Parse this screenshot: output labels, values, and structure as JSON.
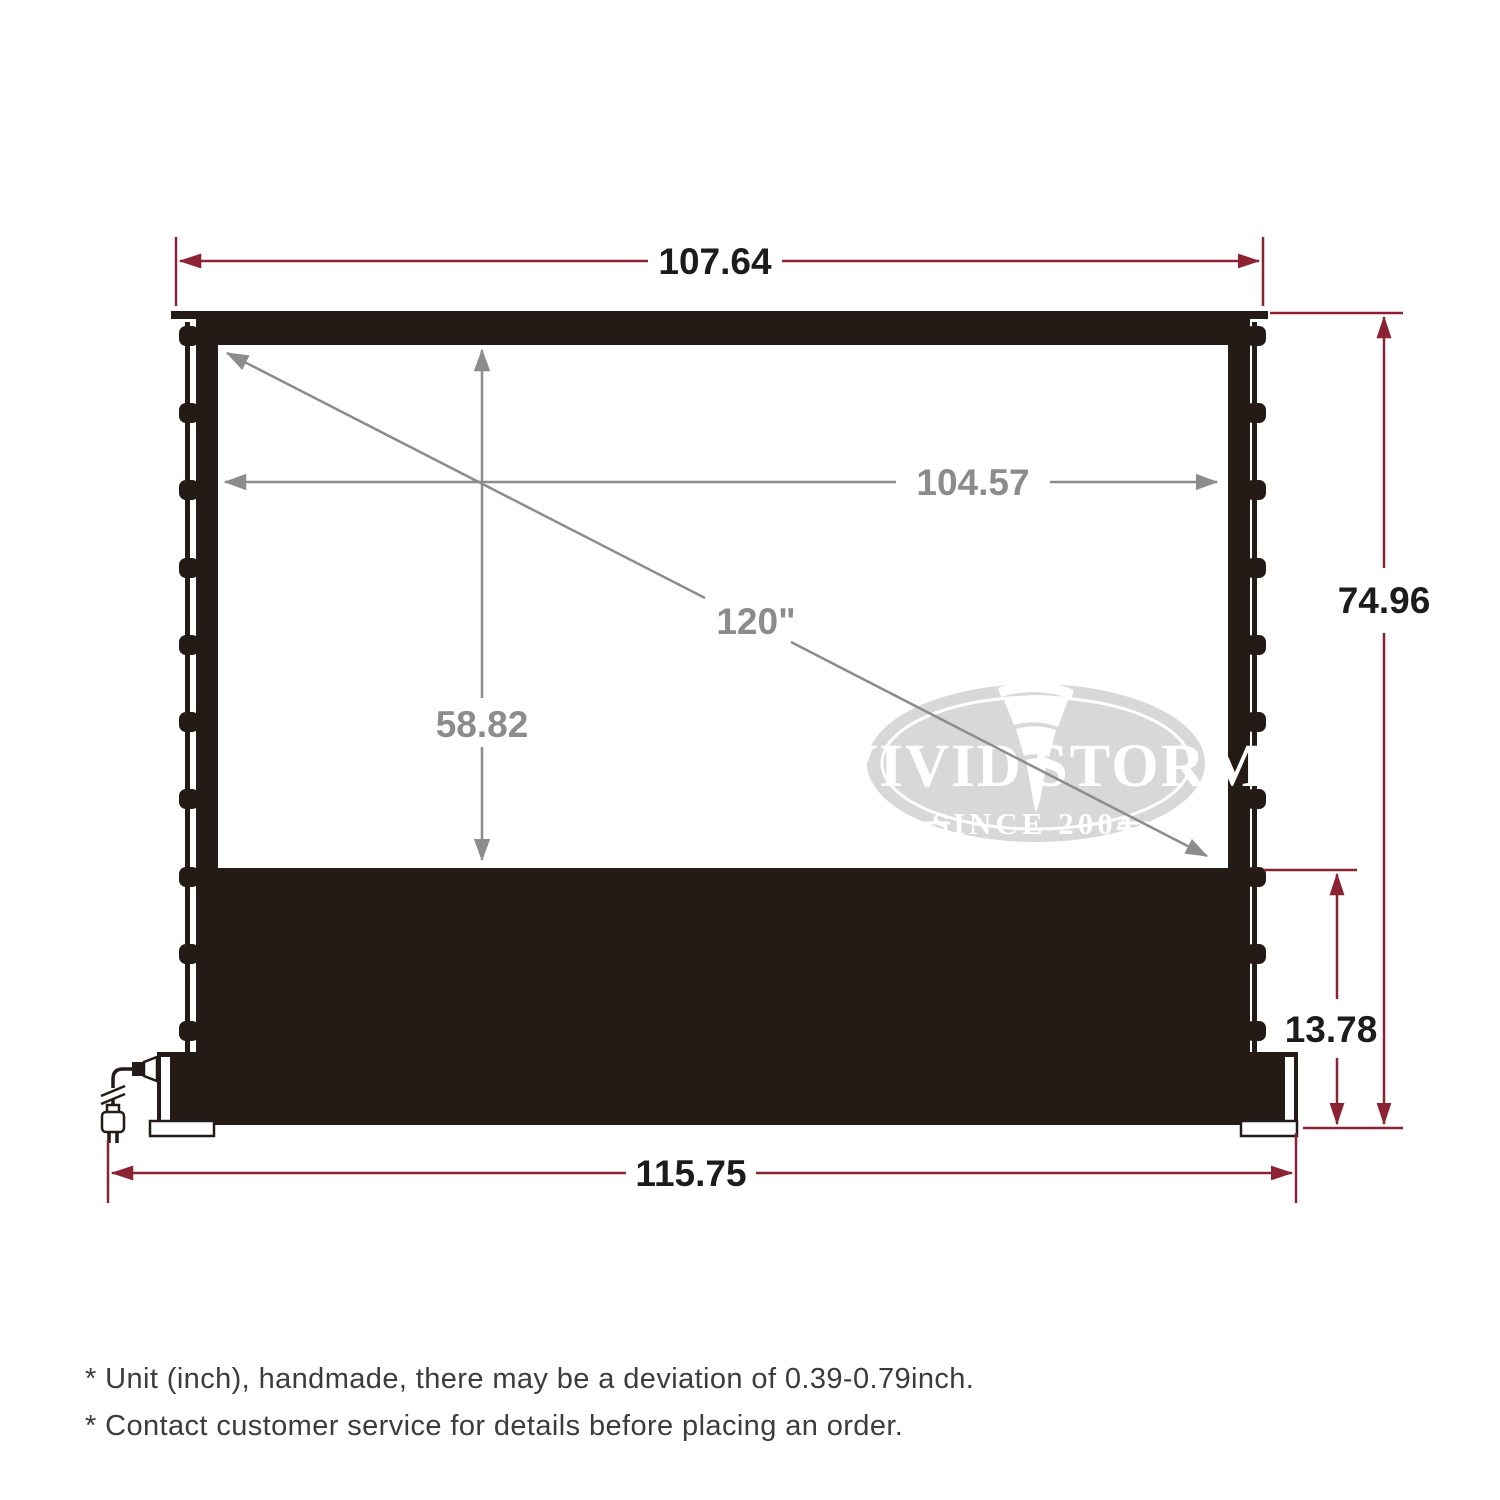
{
  "diagram": {
    "dimensions": {
      "top_width": "107.64",
      "viewing_width": "104.57",
      "viewing_height": "58.82",
      "diagonal": "120\"",
      "overall_height": "74.96",
      "base_height": "13.78",
      "base_width": "115.75"
    },
    "logo": {
      "brand_left": "VIVID",
      "brand_right": "STORM",
      "tagline": "SINCE 2004"
    }
  },
  "footnotes": [
    "* Unit (inch), handmade, there may be a deviation of 0.39-0.79inch.",
    "* Contact customer service for details before placing an order.",
    "* asterisk-note"
  ],
  "colors": {
    "dimension_red": "#8b2332",
    "annotation_gray": "#8c8c8c",
    "frame_dark": "#241a16",
    "text_dark": "#1c1c1c",
    "logo_gray": "#d8d8d8",
    "footnote_gray": "#3c3c3c"
  }
}
